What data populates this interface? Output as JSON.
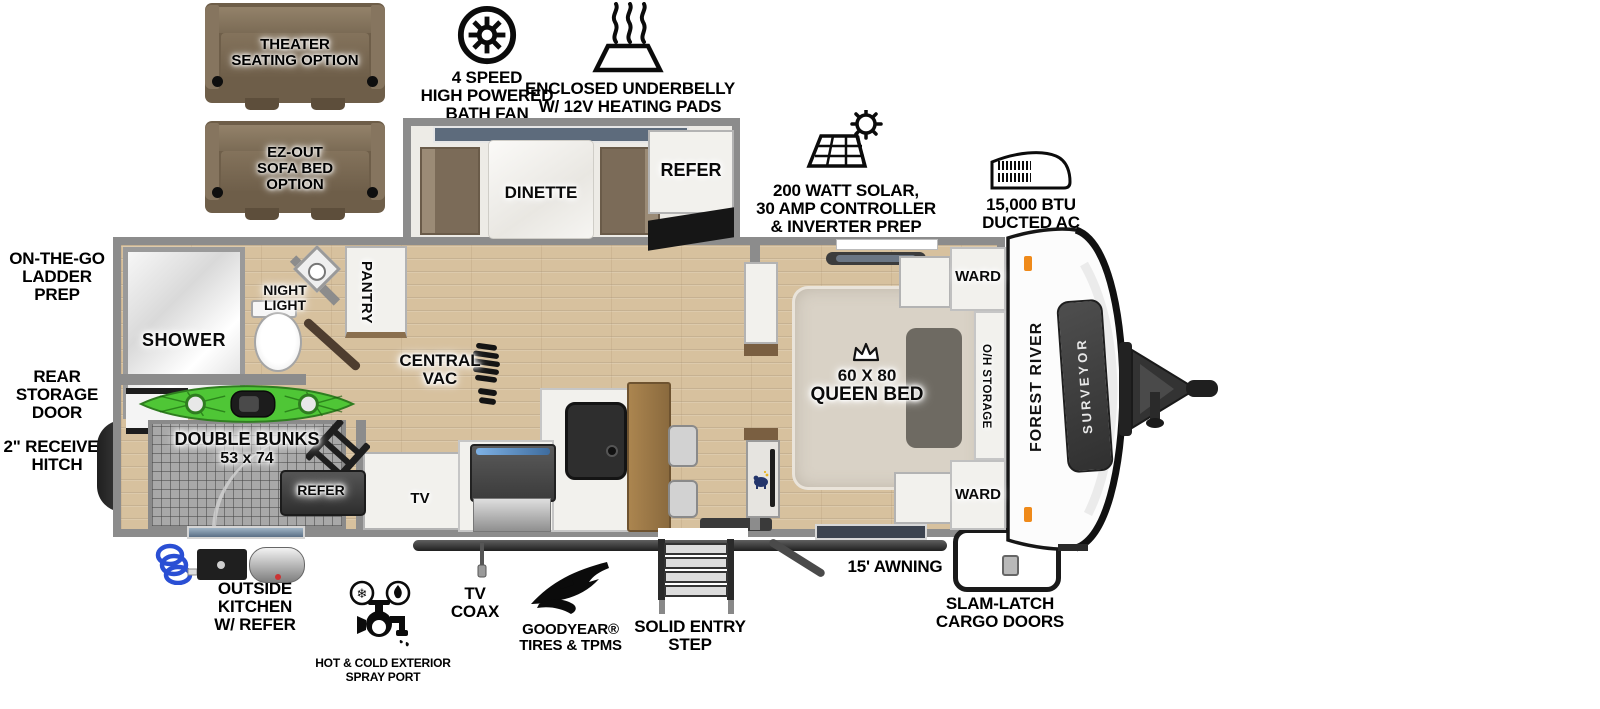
{
  "title": "Surveyor travel trailer floorplan",
  "colors": {
    "wall": "#8c8c8c",
    "floor_wood": "#d7c19e",
    "sofa_brown": "#6e5e49",
    "kayak_green": "#4fc636",
    "marker_orange": "#ef8a1a",
    "counter_black": "#1a1a1a",
    "window_blue": "#5d6b7c"
  },
  "options": {
    "theater": {
      "lines": [
        "THEATER",
        "SEATING OPTION"
      ]
    },
    "sofa_bed": {
      "lines": [
        "EZ-OUT",
        "SOFA BED",
        "OPTION"
      ]
    }
  },
  "features": {
    "bath_fan": {
      "lines": [
        "4 SPEED",
        "HIGH POWERED",
        "BATH FAN"
      ]
    },
    "underbelly": {
      "lines": [
        "ENCLOSED UNDERBELLY",
        "W/ 12V HEATING PADS"
      ]
    },
    "solar": {
      "lines": [
        "200 WATT SOLAR,",
        "30 AMP CONTROLLER",
        "& INVERTER PREP"
      ]
    },
    "ac": {
      "lines": [
        "15,000 BTU",
        "DUCTED AC"
      ]
    }
  },
  "exterior": {
    "ladder_prep": {
      "lines": [
        "ON-THE-GO",
        "LADDER PREP"
      ]
    },
    "rear_storage": {
      "lines": [
        "REAR STORAGE",
        "DOOR"
      ]
    },
    "receiver_hitch": {
      "lines": [
        "2\" RECEIVER",
        "HITCH"
      ]
    },
    "outside_kitchen": {
      "lines": [
        "OUTSIDE KITCHEN",
        "W/ REFER"
      ]
    },
    "spray_port": {
      "lines": [
        "HOT & COLD EXTERIOR",
        "SPRAY PORT"
      ]
    },
    "tv_coax": {
      "lines": [
        "TV",
        "COAX"
      ]
    },
    "goodyear": {
      "lines": [
        "GOODYEAR®",
        "TIRES & TPMS"
      ]
    },
    "entry_step": {
      "lines": [
        "SOLID ENTRY",
        "STEP"
      ]
    },
    "awning": "15' AWNING",
    "slam_latch": {
      "lines": [
        "SLAM-LATCH",
        "CARGO DOORS"
      ]
    }
  },
  "rooms": {
    "dinette": "DINETTE",
    "refer": "REFER",
    "pantry": "PANTRY",
    "shower": "SHOWER",
    "night_light": {
      "lines": [
        "NIGHT",
        "LIGHT"
      ]
    },
    "central_vac": {
      "lines": [
        "CENTRAL",
        "VAC"
      ]
    },
    "tv": "TV",
    "double_bunks": {
      "lines": [
        "DOUBLE BUNKS",
        "53 x 74"
      ]
    },
    "bunk_refer": "REFER",
    "queen_bed": {
      "lines": [
        "60 X 80",
        "QUEEN BED"
      ]
    },
    "ward_top": "WARD",
    "ward_bottom": "WARD",
    "oh_storage": "O/H STORAGE"
  },
  "branding": {
    "make": "FOREST RIVER",
    "model": "SURVEYOR"
  }
}
